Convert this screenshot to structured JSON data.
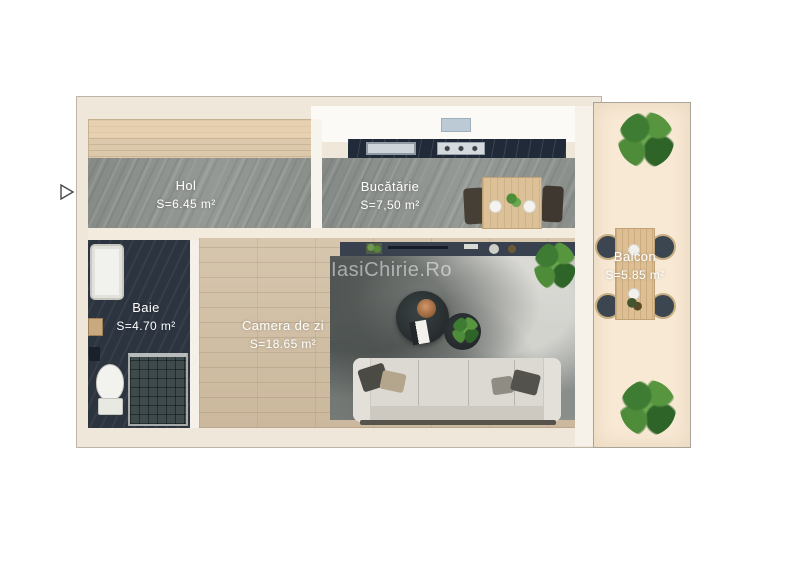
{
  "watermark": "IasiChirie.Ro",
  "rooms": {
    "hol": {
      "name": "Hol",
      "area": "S=6.45 m²"
    },
    "bucatarie": {
      "name": "Bucătărie",
      "area": "S=7,50 m²"
    },
    "baie": {
      "name": "Baie",
      "area": "S=4.70 m²"
    },
    "camera_de_zi": {
      "name": "Camera de zi",
      "area": "S=18.65 m²"
    },
    "balcon": {
      "name": "Balcon",
      "area": "S=5.85 m²"
    }
  },
  "colors": {
    "wall_cream": "#efe7da",
    "stone_floor": "#8d918d",
    "wood_floor": "#cfbda4",
    "bath_floor_dark": "#2c3440",
    "balcony_floor": "#f8e9d5",
    "kitchen_counter": "#202a38",
    "label_text": "#ffffff"
  }
}
